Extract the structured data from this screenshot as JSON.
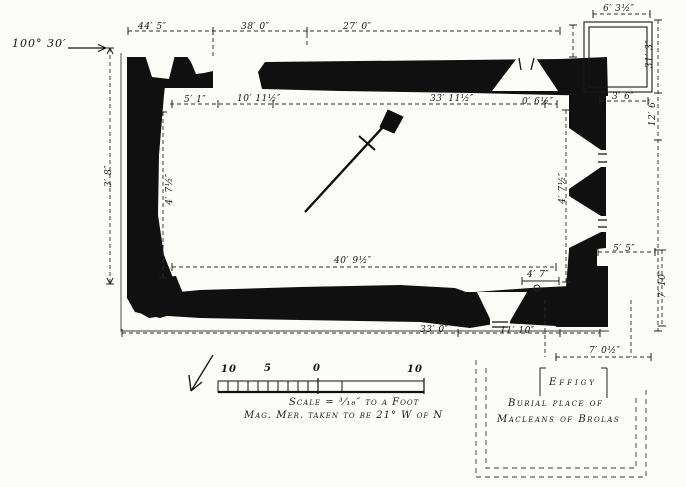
{
  "labels": {
    "bearing": "100° 30′",
    "effigy": "Effigy",
    "burial_line1": "Burial place of",
    "burial_line2": "Macleans of Brolas"
  },
  "dims": {
    "top_left_span": "44′ 5″",
    "top_mid_span": "38′ 0″",
    "top_right_span": "27′ 0″",
    "annexe_width": "6′ 3½″",
    "inner_west_offset": "5′ 1″",
    "inner_door_span": "10′ 11½″",
    "inner_nave_span": "33′ 11½″",
    "inner_east_offset": "0′ 6½″",
    "annexe_gap": "3′ 6″",
    "right_upper": "31′ 3″",
    "right_mid": "12′ 6″",
    "left_outer": "3′ 8″",
    "left_inner": "4′ 7½″",
    "right_inner": "4′ 7½″",
    "inner_length": "40′ 9½″",
    "se_step": "5′ 5″",
    "south_window": "4′ 7″",
    "right_lower": "7′ 10″",
    "bottom_left_span": "33′ 0″",
    "bottom_right_span": "11′ 10″",
    "enclosure_width": "7′ 0½″"
  },
  "scale_bar": {
    "t10l": "10",
    "t5": "5",
    "t0": "0",
    "t10r": "10"
  },
  "captions": {
    "scale": "Scale = ³⁄₁₆″ to a Foot",
    "magnetic": "Mag. Mer. taken to be 21° W of N"
  },
  "colors": {
    "ink": "#141414",
    "paper": "#fcfcf9"
  }
}
